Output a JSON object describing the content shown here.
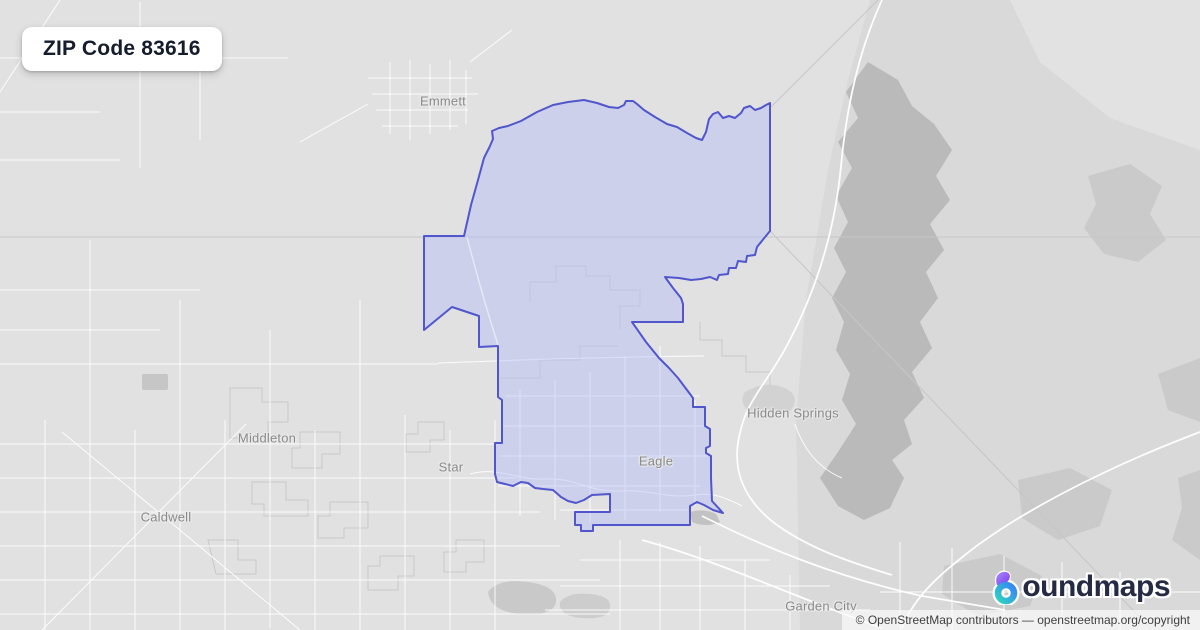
{
  "title_card": {
    "label": "ZIP Code 83616"
  },
  "map": {
    "labels": [
      {
        "name": "Emmett"
      },
      {
        "name": "Middleton"
      },
      {
        "name": "Star"
      },
      {
        "name": "Caldwell"
      },
      {
        "name": "Eagle"
      },
      {
        "name": "Hidden Springs"
      },
      {
        "name": "Garden City"
      }
    ],
    "boundary": {
      "zip_code": "83616",
      "stroke_color": "#5156cc",
      "fill_color": "rgba(180,189,248,0.45)"
    }
  },
  "logo": {
    "brand": "boundmaps",
    "wordmark_rest": "oundmaps",
    "colors": {
      "purple": "#7c3aed",
      "teal": "#2dd4bf",
      "blue": "#3b82f6",
      "navy": "#262b45"
    }
  },
  "attribution": {
    "text": "© OpenStreetMap contributors — openstreetmap.org/copyright"
  }
}
